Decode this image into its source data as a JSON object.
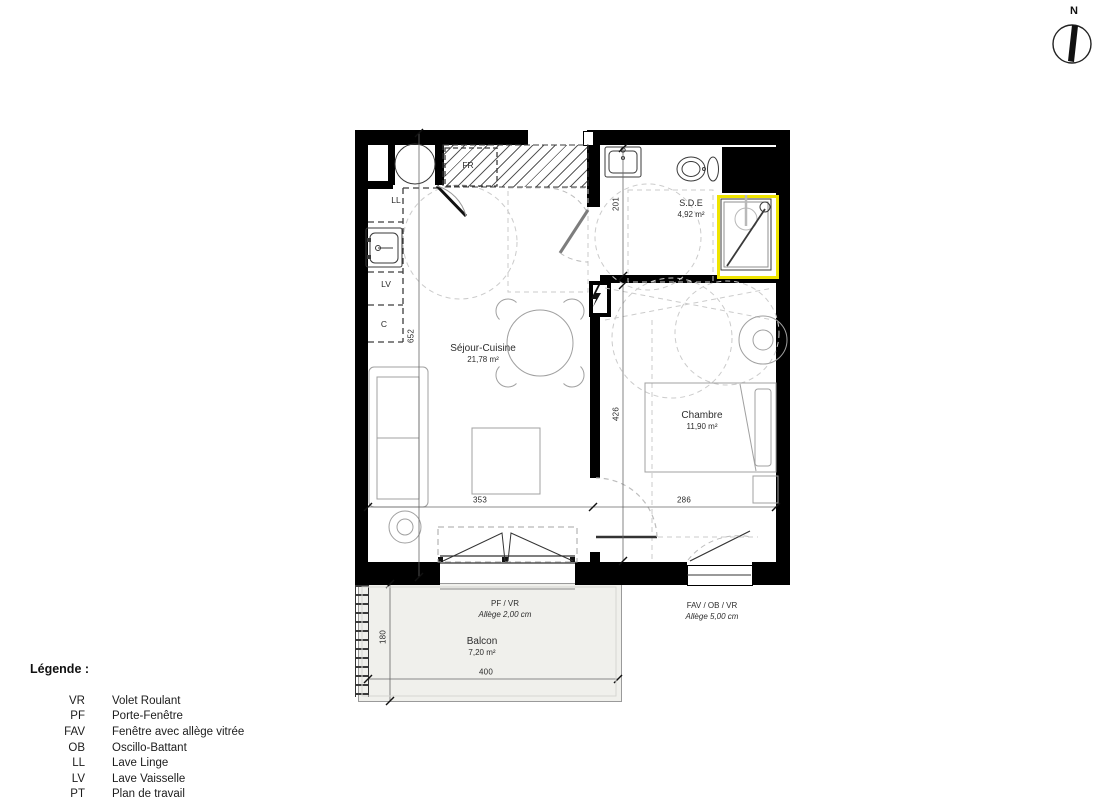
{
  "compass": {
    "north_label": "N"
  },
  "rooms": {
    "sejour": {
      "name": "Séjour-Cuisine",
      "area": "21,78 m²"
    },
    "chambre": {
      "name": "Chambre",
      "area": "11,90 m²"
    },
    "sde": {
      "name": "S.D.E",
      "area": "4,92 m²"
    },
    "balcon": {
      "name": "Balcon",
      "area": "7,20 m²"
    }
  },
  "appliance_labels": {
    "fr": "FR",
    "ll": "LL",
    "lv": "LV",
    "c": "C"
  },
  "dimensions": {
    "sejour_width": "353",
    "chambre_width": "286",
    "sejour_height": "652",
    "chambre_height": "426",
    "sde_height": "201",
    "balcon_width": "400",
    "balcon_depth": "180"
  },
  "openings": {
    "pf": {
      "type": "PF / VR",
      "allege": "Allège   2,00  cm"
    },
    "fav": {
      "type": "FAV / OB / VR",
      "allege": "Allège   5,00  cm"
    }
  },
  "legend": {
    "title": "Légende :",
    "items": [
      {
        "abbr": "VR",
        "label": "Volet Roulant"
      },
      {
        "abbr": "PF",
        "label": "Porte-Fenêtre"
      },
      {
        "abbr": "FAV",
        "label": "Fenêtre avec allège vitrée"
      },
      {
        "abbr": "OB",
        "label": "Oscillo-Battant"
      },
      {
        "abbr": "LL",
        "label": "Lave Linge"
      },
      {
        "abbr": "LV",
        "label": "Lave Vaisselle"
      },
      {
        "abbr": "PT",
        "label": "Plan de travail"
      }
    ]
  },
  "colors": {
    "wall": "#000000",
    "shower_highlight": "#efe400",
    "balcony_fill": "#f0f0ec",
    "dashed_guide": "#cbcbcb",
    "furniture": "#a0a0a0"
  }
}
